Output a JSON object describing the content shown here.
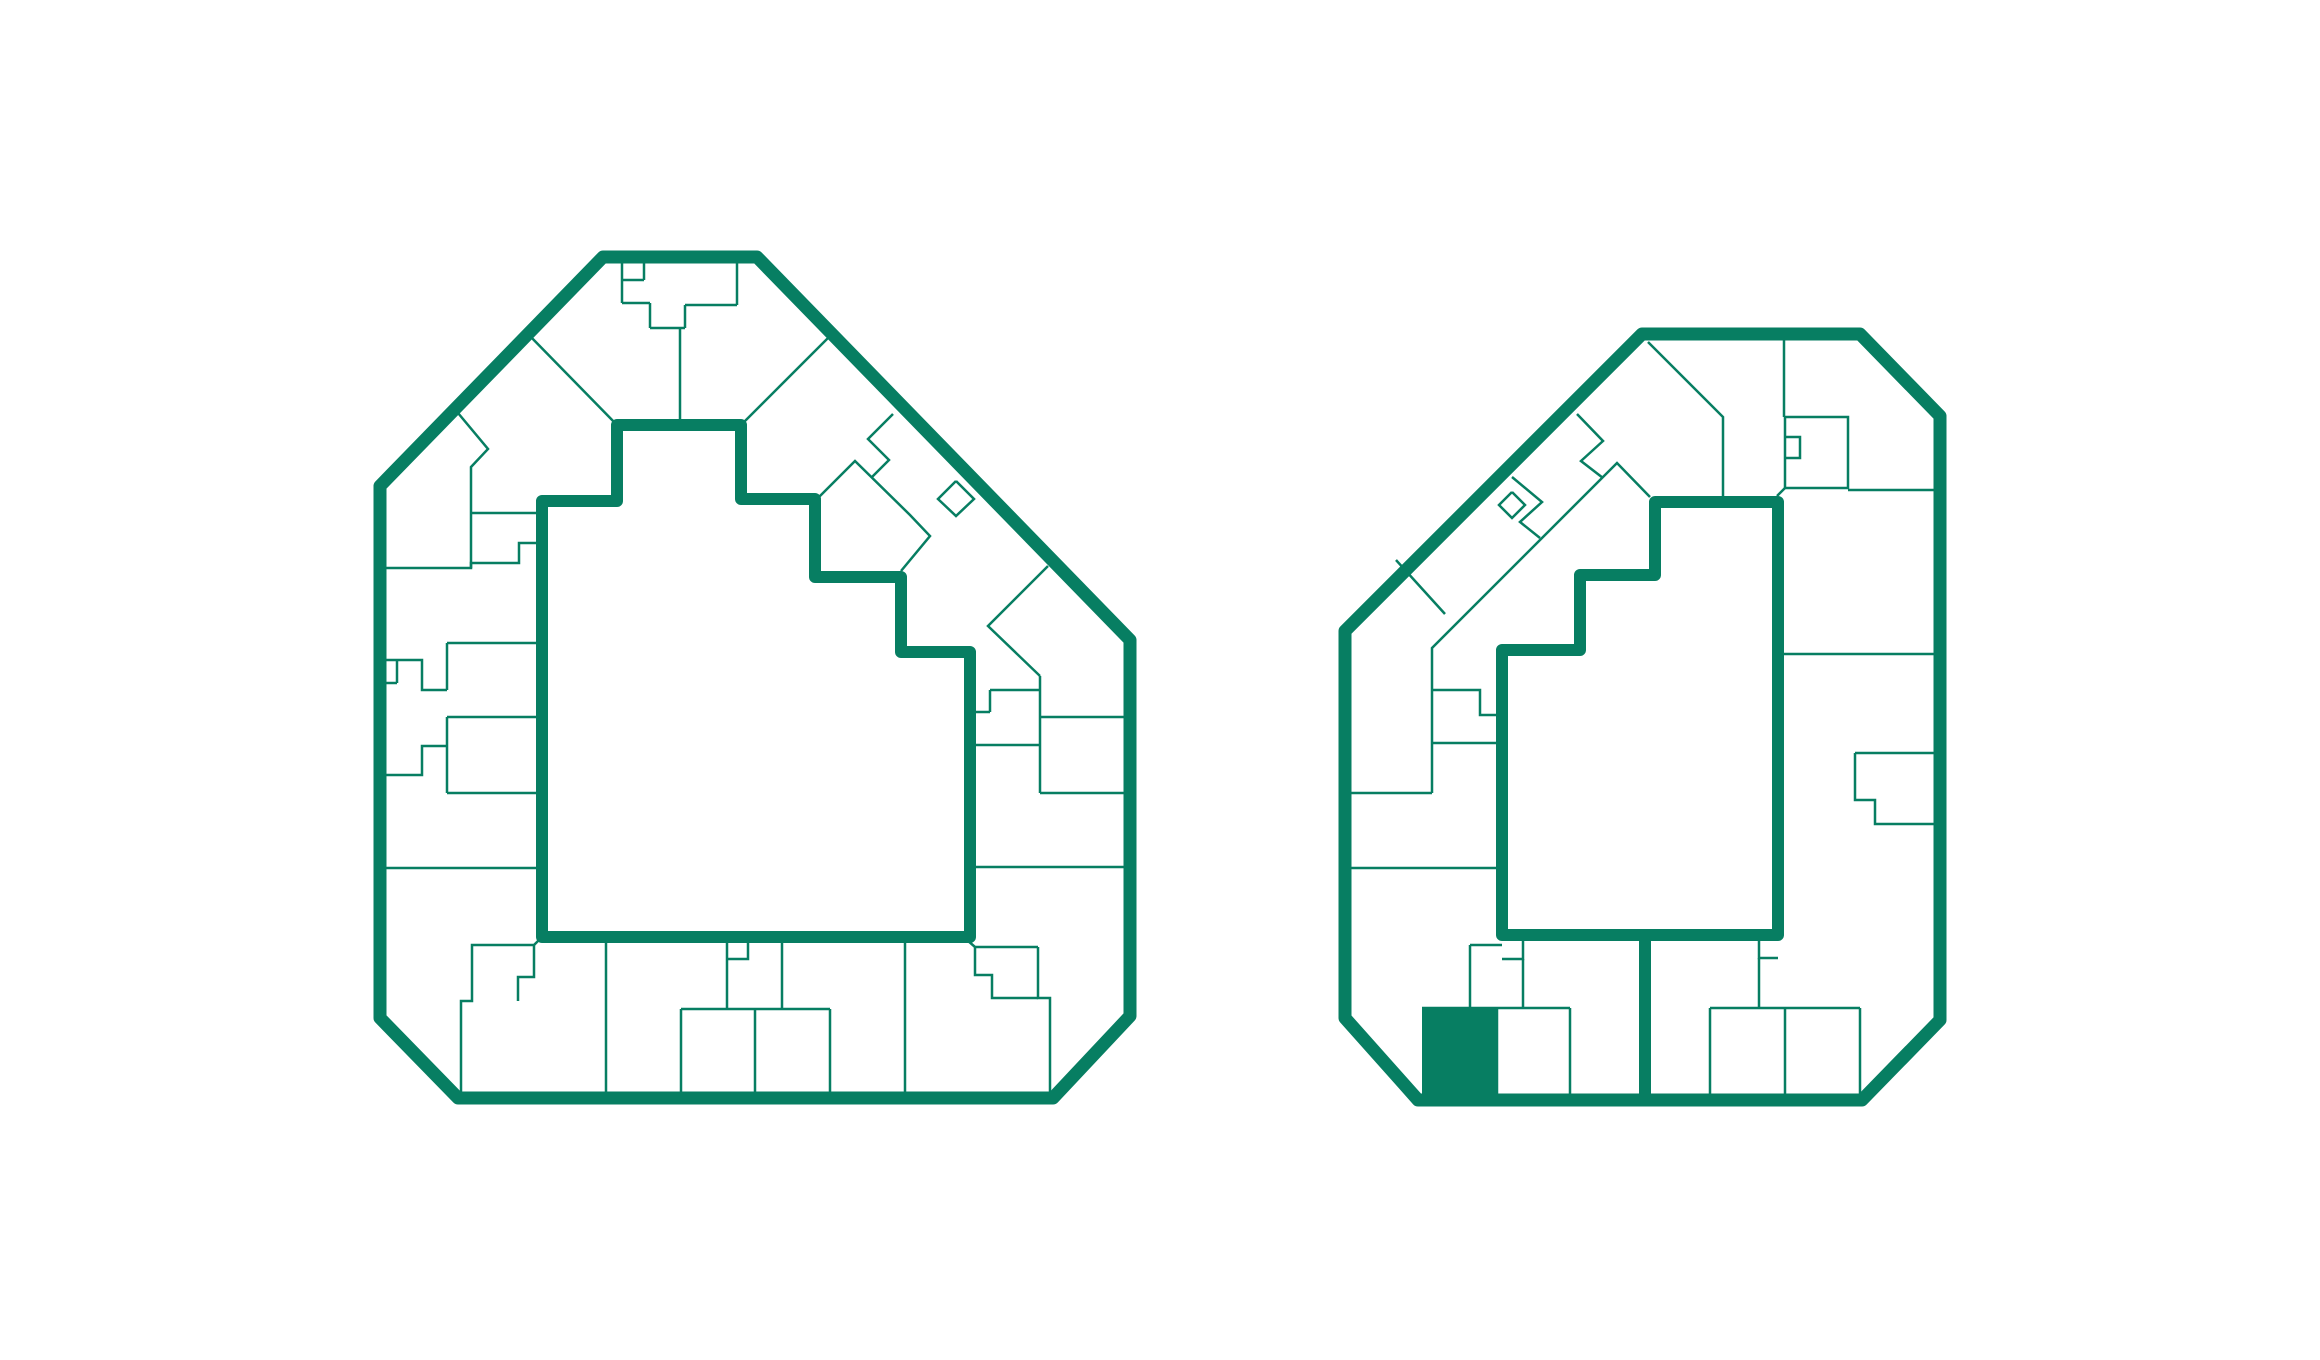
{
  "canvas": {
    "width": 2320,
    "height": 1360,
    "background": "#ffffff"
  },
  "palette": {
    "accent_green": "#077E62",
    "white": "#ffffff"
  },
  "strokes": {
    "outer_width": 13,
    "inner_width": 12,
    "unit_width": 2.5
  },
  "floorplans": [
    {
      "id": "building-a",
      "name": "building-a-floorplan",
      "outer": [
        [
          603,
          257
        ],
        [
          757,
          257
        ],
        [
          1130,
          640
        ],
        [
          1130,
          1016
        ],
        [
          1053,
          1098
        ],
        [
          458,
          1098
        ],
        [
          380,
          1018
        ],
        [
          380,
          486
        ]
      ],
      "courtyard": [
        [
          617,
          425
        ],
        [
          741,
          425
        ],
        [
          741,
          499
        ],
        [
          815,
          499
        ],
        [
          815,
          577
        ],
        [
          901,
          577
        ],
        [
          901,
          652
        ],
        [
          970,
          652
        ],
        [
          970,
          937
        ],
        [
          542,
          937
        ],
        [
          542,
          501
        ],
        [
          617,
          501
        ]
      ],
      "connectors": [],
      "highlighted_unit": null,
      "unit_lines": [
        [
          [
            622,
            259
          ],
          [
            622,
            303
          ]
        ],
        [
          [
            644,
            259
          ],
          [
            644,
            280
          ]
        ],
        [
          [
            622,
            280
          ],
          [
            644,
            280
          ]
        ],
        [
          [
            622,
            303
          ],
          [
            650,
            303
          ]
        ],
        [
          [
            650,
            303
          ],
          [
            650,
            328
          ]
        ],
        [
          [
            650,
            328
          ],
          [
            685,
            328
          ]
        ],
        [
          [
            685,
            328
          ],
          [
            685,
            305
          ]
        ],
        [
          [
            685,
            305
          ],
          [
            737,
            305
          ]
        ],
        [
          [
            737,
            305
          ],
          [
            737,
            259
          ]
        ],
        [
          [
            680,
            328
          ],
          [
            680,
            425
          ]
        ],
        [
          [
            527,
            333
          ],
          [
            617,
            425
          ]
        ],
        [
          [
            833,
            333
          ],
          [
            741,
            425
          ]
        ],
        [
          [
            453,
            407
          ],
          [
            488,
            449
          ],
          [
            471,
            467
          ],
          [
            471,
            568
          ]
        ],
        [
          [
            471,
            513
          ],
          [
            542,
            513
          ]
        ],
        [
          [
            382,
            568
          ],
          [
            471,
            568
          ],
          [
            471,
            563
          ],
          [
            519,
            563
          ],
          [
            519,
            543
          ],
          [
            542,
            543
          ]
        ],
        [
          [
            382,
            660
          ],
          [
            422,
            660
          ],
          [
            422,
            690
          ],
          [
            447,
            690
          ]
        ],
        [
          [
            397,
            660
          ],
          [
            397,
            683
          ]
        ],
        [
          [
            382,
            683
          ],
          [
            397,
            683
          ]
        ],
        [
          [
            447,
            643
          ],
          [
            447,
            690
          ]
        ],
        [
          [
            447,
            643
          ],
          [
            542,
            643
          ]
        ],
        [
          [
            447,
            717
          ],
          [
            542,
            717
          ]
        ],
        [
          [
            382,
            775
          ],
          [
            422,
            775
          ],
          [
            422,
            746
          ],
          [
            447,
            746
          ]
        ],
        [
          [
            447,
            717
          ],
          [
            447,
            793
          ]
        ],
        [
          [
            447,
            793
          ],
          [
            542,
            793
          ]
        ],
        [
          [
            382,
            868
          ],
          [
            542,
            868
          ]
        ],
        [
          [
            893,
            414
          ],
          [
            868,
            439
          ],
          [
            889,
            460
          ],
          [
            871,
            478
          ]
        ],
        [
          [
            815,
            501
          ],
          [
            855,
            461
          ],
          [
            910,
            515
          ],
          [
            930,
            536
          ],
          [
            901,
            571
          ]
        ],
        [
          [
            956,
            481
          ],
          [
            974,
            499
          ],
          [
            956,
            516
          ],
          [
            938,
            499
          ],
          [
            956,
            481
          ]
        ],
        [
          [
            1048,
            566
          ],
          [
            988,
            626
          ],
          [
            1040,
            676
          ]
        ],
        [
          [
            1040,
            676
          ],
          [
            1040,
            793
          ]
        ],
        [
          [
            990,
            690
          ],
          [
            1040,
            690
          ]
        ],
        [
          [
            990,
            690
          ],
          [
            990,
            712
          ]
        ],
        [
          [
            970,
            712
          ],
          [
            990,
            712
          ]
        ],
        [
          [
            1040,
            717
          ],
          [
            1130,
            717
          ]
        ],
        [
          [
            970,
            745
          ],
          [
            1040,
            745
          ]
        ],
        [
          [
            1040,
            793
          ],
          [
            1130,
            793
          ]
        ],
        [
          [
            970,
            867
          ],
          [
            1130,
            867
          ]
        ],
        [
          [
            967,
            940
          ],
          [
            975,
            947
          ],
          [
            1038,
            947
          ]
        ],
        [
          [
            975,
            947
          ],
          [
            975,
            975
          ],
          [
            992,
            975
          ],
          [
            992,
            998
          ],
          [
            1038,
            998
          ]
        ],
        [
          [
            1038,
            947
          ],
          [
            1038,
            998
          ],
          [
            1050,
            998
          ],
          [
            1050,
            1098
          ]
        ],
        [
          [
            905,
            941
          ],
          [
            905,
            1098
          ]
        ],
        [
          [
            782,
            941
          ],
          [
            782,
            1009
          ]
        ],
        [
          [
            727,
            941
          ],
          [
            727,
            1009
          ]
        ],
        [
          [
            748,
            941
          ],
          [
            748,
            959
          ],
          [
            727,
            959
          ]
        ],
        [
          [
            681,
            1009
          ],
          [
            830,
            1009
          ]
        ],
        [
          [
            681,
            1009
          ],
          [
            681,
            1096
          ]
        ],
        [
          [
            755,
            1009
          ],
          [
            755,
            1096
          ]
        ],
        [
          [
            830,
            1009
          ],
          [
            830,
            1096
          ]
        ],
        [
          [
            606,
            938
          ],
          [
            606,
            1098
          ]
        ],
        [
          [
            541,
            938
          ],
          [
            534,
            945
          ],
          [
            472,
            945
          ],
          [
            472,
            1001
          ],
          [
            461,
            1001
          ],
          [
            461,
            1096
          ]
        ],
        [
          [
            534,
            945
          ],
          [
            534,
            977
          ],
          [
            518,
            977
          ],
          [
            518,
            1001
          ]
        ]
      ]
    },
    {
      "id": "building-b",
      "name": "building-b-floorplan",
      "outer": [
        [
          1642,
          334
        ],
        [
          1860,
          334
        ],
        [
          1940,
          416
        ],
        [
          1940,
          1020
        ],
        [
          1862,
          1100
        ],
        [
          1418,
          1100
        ],
        [
          1345,
          1018
        ],
        [
          1345,
          631
        ]
      ],
      "courtyard": [
        [
          1655,
          502
        ],
        [
          1778,
          502
        ],
        [
          1778,
          935
        ],
        [
          1502,
          935
        ],
        [
          1502,
          650
        ],
        [
          1580,
          650
        ],
        [
          1580,
          575
        ],
        [
          1655,
          575
        ]
      ],
      "connectors": [
        [
          [
            1645,
            935
          ],
          [
            1645,
            1100
          ]
        ]
      ],
      "highlighted_unit": {
        "x": 1422,
        "y": 1008,
        "width": 75,
        "height": 90
      },
      "unit_lines": [
        [
          [
            1648,
            342
          ],
          [
            1723,
            417
          ],
          [
            1723,
            502
          ]
        ],
        [
          [
            1784,
            334
          ],
          [
            1784,
            417
          ]
        ],
        [
          [
            1785,
            417
          ],
          [
            1848,
            417
          ],
          [
            1848,
            488
          ],
          [
            1785,
            488
          ],
          [
            1785,
            417
          ]
        ],
        [
          [
            1785,
            437
          ],
          [
            1800,
            437
          ],
          [
            1800,
            458
          ],
          [
            1785,
            458
          ]
        ],
        [
          [
            1777,
            496
          ],
          [
            1785,
            488
          ]
        ],
        [
          [
            1848,
            490
          ],
          [
            1937,
            490
          ]
        ],
        [
          [
            1577,
            414
          ],
          [
            1603,
            441
          ],
          [
            1581,
            461
          ],
          [
            1603,
            478
          ]
        ],
        [
          [
            1650,
            497
          ],
          [
            1617,
            463
          ],
          [
            1432,
            648
          ],
          [
            1432,
            793
          ]
        ],
        [
          [
            1512,
            492
          ],
          [
            1525,
            505
          ],
          [
            1512,
            518
          ],
          [
            1499,
            505
          ],
          [
            1512,
            492
          ]
        ],
        [
          [
            1512,
            477
          ],
          [
            1542,
            502
          ],
          [
            1520,
            522
          ],
          [
            1540,
            538
          ]
        ],
        [
          [
            1396,
            560
          ],
          [
            1445,
            614
          ]
        ],
        [
          [
            1432,
            690
          ],
          [
            1480,
            690
          ],
          [
            1480,
            715
          ],
          [
            1502,
            715
          ]
        ],
        [
          [
            1432,
            743
          ],
          [
            1502,
            743
          ]
        ],
        [
          [
            1351,
            793
          ],
          [
            1432,
            793
          ]
        ],
        [
          [
            1345,
            868
          ],
          [
            1502,
            868
          ]
        ],
        [
          [
            1470,
            945
          ],
          [
            1502,
            945
          ]
        ],
        [
          [
            1470,
            945
          ],
          [
            1470,
            1008
          ]
        ],
        [
          [
            1523,
            938
          ],
          [
            1523,
            959
          ],
          [
            1502,
            959
          ]
        ],
        [
          [
            1523,
            959
          ],
          [
            1523,
            1008
          ]
        ],
        [
          [
            1422,
            1008
          ],
          [
            1570,
            1008
          ]
        ],
        [
          [
            1570,
            1008
          ],
          [
            1570,
            1097
          ]
        ],
        [
          [
            1497,
            1008
          ],
          [
            1497,
            1095
          ]
        ],
        [
          [
            1759,
            941
          ],
          [
            1759,
            958
          ],
          [
            1778,
            958
          ]
        ],
        [
          [
            1759,
            958
          ],
          [
            1759,
            1008
          ]
        ],
        [
          [
            1710,
            1008
          ],
          [
            1860,
            1008
          ]
        ],
        [
          [
            1710,
            1008
          ],
          [
            1710,
            1097
          ]
        ],
        [
          [
            1785,
            1008
          ],
          [
            1785,
            1097
          ]
        ],
        [
          [
            1860,
            1008
          ],
          [
            1860,
            1097
          ]
        ],
        [
          [
            1781,
            654
          ],
          [
            1937,
            654
          ]
        ],
        [
          [
            1855,
            753
          ],
          [
            1937,
            753
          ]
        ],
        [
          [
            1855,
            753
          ],
          [
            1855,
            800
          ],
          [
            1875,
            800
          ],
          [
            1875,
            824
          ],
          [
            1937,
            824
          ]
        ]
      ]
    }
  ]
}
